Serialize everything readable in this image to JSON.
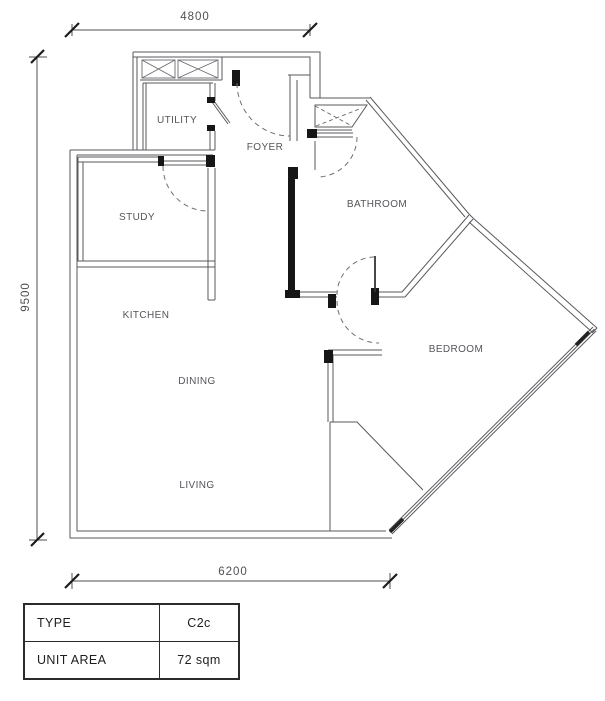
{
  "dimensions": {
    "top": "4800",
    "left": "9500",
    "bottom": "6200"
  },
  "rooms": {
    "utility": "UTILITY",
    "foyer": "FOYER",
    "study": "STUDY",
    "bathroom": "BATHROOM",
    "kitchen": "KITCHEN",
    "dining": "DINING",
    "bedroom": "BEDROOM",
    "living": "LIVING"
  },
  "table": {
    "rows": [
      {
        "label": "TYPE",
        "value": "C2c"
      },
      {
        "label": "UNIT AREA",
        "value": "72 sqm"
      }
    ]
  },
  "colors": {
    "wall_line": "#595a5e",
    "solid_wall": "#161616",
    "dashed_door": "#6e6f73",
    "dimension": "#4e4f53"
  }
}
